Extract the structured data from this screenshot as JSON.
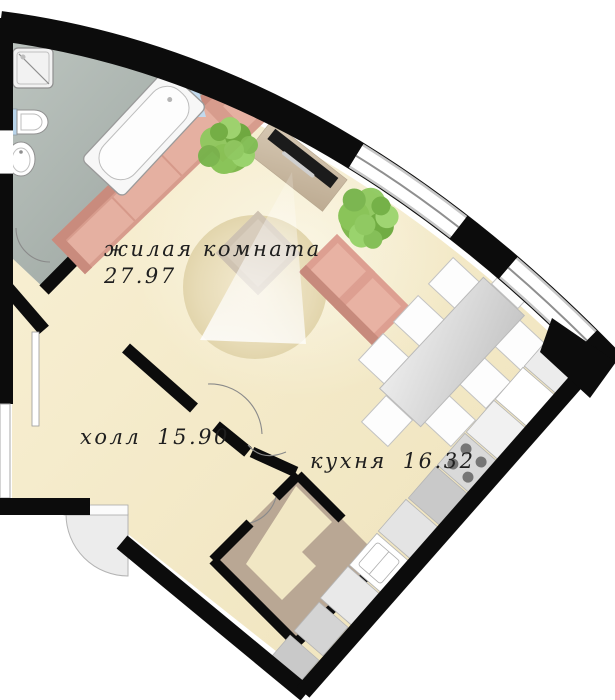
{
  "plan": {
    "type": "apartment-floor-plan",
    "language": "ru",
    "rooms": [
      {
        "id": "living-room",
        "name": "жилая комната",
        "area": "27.97"
      },
      {
        "id": "hall",
        "name": "холл",
        "area": "15.90"
      },
      {
        "id": "kitchen",
        "name": "кухня",
        "area": "16.32"
      }
    ],
    "colors": {
      "wall": "#0c0c0c",
      "floor_main": "#f5ecc9",
      "floor_bathroom": "#aab3ae",
      "floor_wardrobe": "#b9a794",
      "sofa": "#dfa395",
      "tree": "#7cbb4e",
      "window_glass": "#c2daee",
      "counter": "#d9d9d9"
    },
    "furniture_icons": [
      "shower-tray",
      "toilet",
      "sink",
      "bathtub",
      "corner-sofa",
      "two-seat-sofa",
      "tv-stand",
      "tv",
      "round-rug",
      "light-beam",
      "armchair-table",
      "tree",
      "dining-table",
      "dining-chair",
      "kitchen-counter",
      "stove",
      "kitchen-sink",
      "appliance",
      "entrance-door",
      "interior-door-arc",
      "window-band"
    ]
  }
}
